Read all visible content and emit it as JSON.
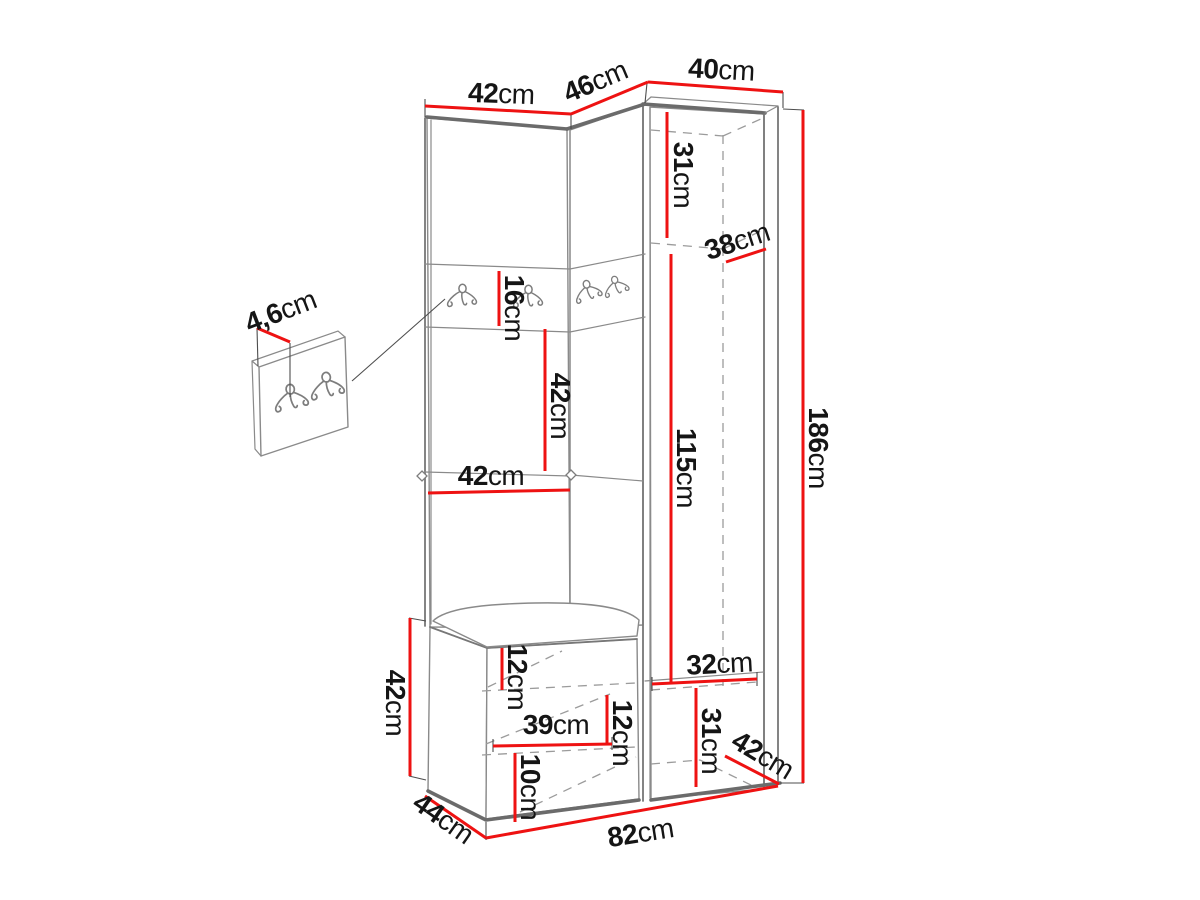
{
  "title": "corner-hallway-wardrobe-dimension-diagram",
  "colors": {
    "dimension_line": "#ee1212",
    "outline": "#6b6b6b",
    "text": "#151515",
    "background": "#ffffff"
  },
  "icons": {
    "hook": "double-coat-hook"
  },
  "dimensions": {
    "top_left_width": {
      "value": "42",
      "unit": "cm"
    },
    "top_angled_width": {
      "value": "46",
      "unit": "cm"
    },
    "top_right_width": {
      "value": "40",
      "unit": "cm"
    },
    "right_upper_height": {
      "value": "31",
      "unit": "cm"
    },
    "right_upper_depth": {
      "value": "38",
      "unit": "cm"
    },
    "hook_panel_height": {
      "value": "16",
      "unit": "cm"
    },
    "left_open_height": {
      "value": "42",
      "unit": "cm"
    },
    "left_shelf_width": {
      "value": "42",
      "unit": "cm"
    },
    "right_middle_height": {
      "value": "115",
      "unit": "cm"
    },
    "total_height": {
      "value": "186",
      "unit": "cm"
    },
    "panel_thickness": {
      "value": "4,6",
      "unit": "cm"
    },
    "bench_height": {
      "value": "42",
      "unit": "cm"
    },
    "bench_top_inset": {
      "value": "12",
      "unit": "cm"
    },
    "bench_inner_width": {
      "value": "39",
      "unit": "cm"
    },
    "bench_inner_height": {
      "value": "12",
      "unit": "cm"
    },
    "bench_bottom_height": {
      "value": "10",
      "unit": "cm"
    },
    "right_lower_width": {
      "value": "32",
      "unit": "cm"
    },
    "right_lower_height": {
      "value": "31",
      "unit": "cm"
    },
    "right_lower_depth": {
      "value": "42",
      "unit": "cm"
    },
    "total_width": {
      "value": "82",
      "unit": "cm"
    },
    "bench_depth": {
      "value": "44",
      "unit": "cm"
    }
  }
}
